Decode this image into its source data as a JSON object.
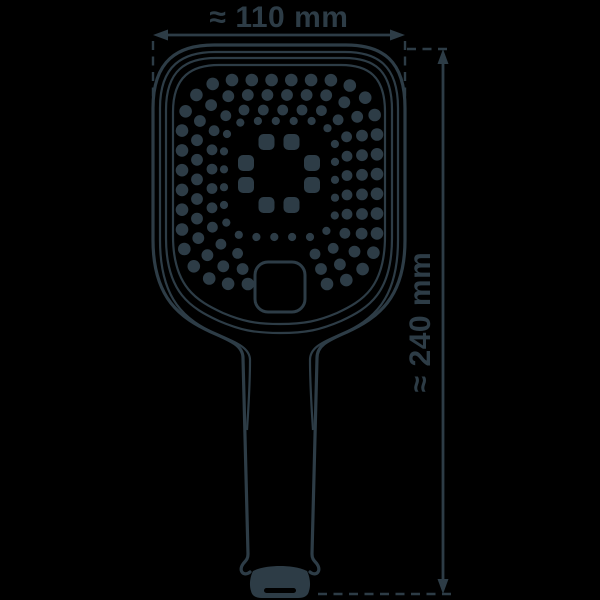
{
  "dimensions": {
    "width_label": "≈ 110 mm",
    "height_label": "≈ 240 mm"
  },
  "colors": {
    "ink": "#2d3c46",
    "background": "#000000"
  }
}
